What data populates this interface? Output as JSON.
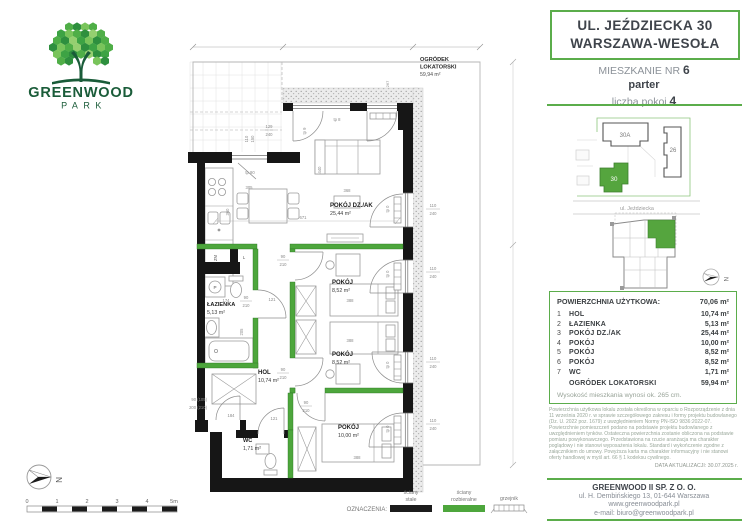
{
  "logo": {
    "name": "GREENWOOD",
    "sub": "PARK"
  },
  "header": {
    "address_line1": "UL. JEŹDZIECKA 30",
    "address_line2": "WARSZAWA-WESOŁA",
    "unit_label": "MIESZKANIE NR",
    "unit_number": "6",
    "floor": "parter",
    "rooms_label": "liczba pokoi",
    "rooms_count": "4"
  },
  "site_plan": {
    "building_a": "30A",
    "building_b": "26",
    "building_c": "30",
    "street": "ul. Jeździecka",
    "compass_letter": "N"
  },
  "plan": {
    "garden": {
      "l1": "OGRÓDEK",
      "l2": "LOKATORSKI",
      "area": "59,94 m²"
    },
    "rooms": {
      "living": {
        "name": "POKÓJ DZ./AK",
        "area": "25,44 m²"
      },
      "room5": {
        "name": "POKÓJ",
        "area": "8,52 m²"
      },
      "room6": {
        "name": "POKÓJ",
        "area": "8,52 m²"
      },
      "room4": {
        "name": "POKÓJ",
        "area": "10,00 m²"
      },
      "hol": {
        "name": "HOL",
        "area": "10,74 m²"
      },
      "bath": {
        "name": "ŁAZIENKA",
        "area": "5,13 m²"
      },
      "wc": {
        "name": "WC",
        "area": "1,71 m²"
      }
    },
    "dims": {
      "w110": "110",
      "w240": "240",
      "k129": "129",
      "k240": "240",
      "k110": "110",
      "k150": "150",
      "d90": "90",
      "d210": "210",
      "entry_w": "90 (105)",
      "entry_h": "200 (210)",
      "d671": "671",
      "d305": "305",
      "d360": "360",
      "d368": "368",
      "d388": "388",
      "d121": "121",
      "d174": "174",
      "d184": "184",
      "d205": "205",
      "d440": "440",
      "d267": "267",
      "d240b": "240",
      "tp0": "tp 0",
      "tp8": "tp 8",
      "tp9": "tp 9",
      "tp90": "tp 90",
      "zm": "ZM",
      "l": "L",
      "p": "P"
    }
  },
  "legend": {
    "title": "OZNACZENIA:",
    "solid1": "ściany",
    "solid2": "stałe",
    "demount1": "ściany",
    "demount2": "rozbieralne",
    "radiator": "grzejnik"
  },
  "scale_bar": {
    "labels": [
      "0",
      "1",
      "2",
      "3",
      "4",
      "5m"
    ]
  },
  "compass_letter": "N",
  "table": {
    "title": "POWIERZCHNIA UŻYTKOWA:",
    "total": "70,06 m²",
    "rows": [
      {
        "no": "1",
        "name": "HOL",
        "area": "10,74 m²"
      },
      {
        "no": "2",
        "name": "ŁAZIENKA",
        "area": "5,13 m²"
      },
      {
        "no": "3",
        "name": "POKÓJ DZ./AK",
        "area": "25,44 m²"
      },
      {
        "no": "4",
        "name": "POKÓJ",
        "area": "10,00 m²"
      },
      {
        "no": "5",
        "name": "POKÓJ",
        "area": "8,52 m²"
      },
      {
        "no": "6",
        "name": "POKÓJ",
        "area": "8,52 m²"
      },
      {
        "no": "7",
        "name": "WC",
        "area": "1,71 m²"
      }
    ],
    "garden_label": "OGRÓDEK LOKATORSKI",
    "garden_area": "59,94 m²",
    "height_note": "Wysokość mieszkania wynosi ok. 265 cm."
  },
  "disclaimer": {
    "text": "Powierzchnia użytkowa lokalu została określona w oparciu o Rozporządzenie z dnia 11 września 2020 r. w sprawie szczegółowego zakresu i formy projektu budowlanego (Dz. U. 2022 poz. 1679) z uwzględnieniem Normy PN-ISO 9836:2022-07. Powierzchnie pomieszczeń podano na podstawie projektu budowlanego z uwzględnieniem tynków. Ostateczna powierzchnia zostanie obliczona na podstawie pomiaru powykonawczego. Przedstawiona na rzucie aranżacja ma charakter poglądowy i nie stanowi wyposażenia lokalu. Standard i wykończenie zgodne z załącznikiem do umowy. Powyższa karta ma charakter informacyjny i nie stanowi oferty handlowej w myśl art. 66 § 1 kodeksu cywilnego.",
    "date": "DATA AKTUALIZACJI: 30.07.2025 r."
  },
  "company": {
    "name": "GREENWOOD II SP. Z O. O.",
    "address": "ul. H. Dembińskiego 13, 01-644 Warszawa",
    "web": "www.greenwoodpark.pl",
    "email": "e-mail: biuro@greenwoodpark.pl"
  },
  "colors": {
    "accent": "#5bad4b",
    "wall": "#161616",
    "demountable_wall": "#4da63c",
    "logo_green": "#1a5c39",
    "site_green": "#55a53e"
  }
}
